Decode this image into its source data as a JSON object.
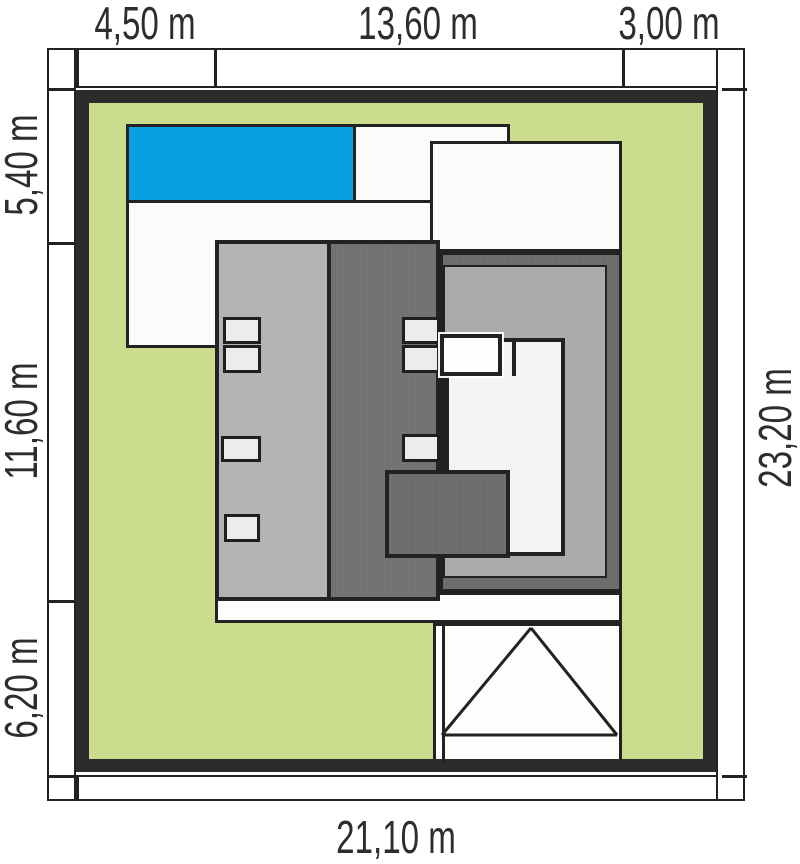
{
  "dimensions": {
    "top": [
      "4,50 m",
      "13,60 m",
      "3,00 m"
    ],
    "left": [
      "5,40 m",
      "11,60 m",
      "6,20 m"
    ],
    "right": [
      "23,20 m"
    ],
    "bottom": [
      "21,10 m"
    ]
  },
  "colors": {
    "lawn": "#ccdc8f",
    "fence": "#2b2b2b",
    "outline": "#222222",
    "pool": "#099fe3",
    "terrace": "#fbfbfb",
    "roof-light": "#b2b2b2",
    "roof-dark": "#757575",
    "roof-annex": "#6f6f6f",
    "roof-medium": "#ababab",
    "window": "#ececec"
  }
}
